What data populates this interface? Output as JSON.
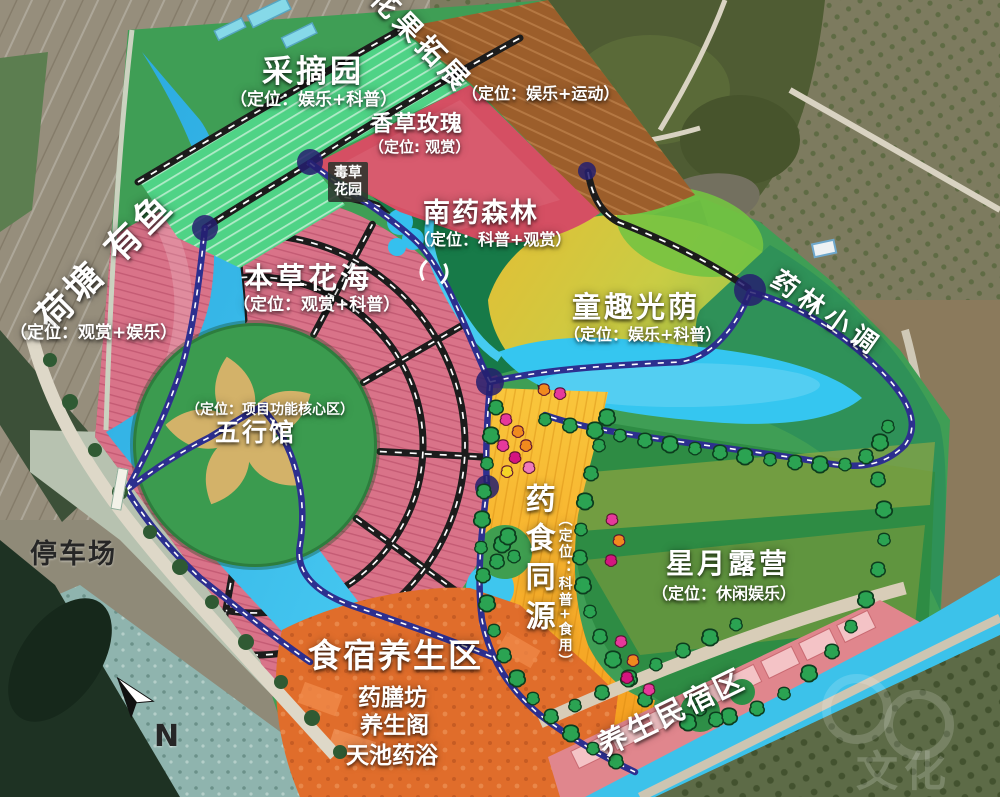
{
  "map": {
    "zones": {
      "caizhaiyuan": {
        "title": "采摘园",
        "subtitle": "（定位：娱乐+科普）"
      },
      "huaguotuozhan": {
        "title": "花果拓展",
        "subtitle": "（定位：娱乐+运动）"
      },
      "xiangcaomeigui": {
        "title": "香草玫瑰",
        "subtitle": "（定位: 观赏）"
      },
      "ducaohuayuan": {
        "line1": "毒草",
        "line2": "花园"
      },
      "nanyaosenlin": {
        "title": "南药森林",
        "subtitle": "（定位：科普+观赏）"
      },
      "hetangyouyu": {
        "title": "荷塘 有鱼",
        "subtitle": "（定位：观赏+娱乐）"
      },
      "bencaohuahai": {
        "title": "本草花海",
        "subtitle": "（定位：观赏+科普）"
      },
      "wuxingguan": {
        "title": "五行馆",
        "subtitle": "（定位：项目功能核心区）"
      },
      "tongquguangyin": {
        "title": "童趣光荫",
        "subtitle": "（定位：娱乐+科普）"
      },
      "yaolinxiaodiao": {
        "title": "药林小调"
      },
      "yaoshitongyuan": {
        "title": "药食同源",
        "subtitle": "（定位：科普+食用）"
      },
      "xingyueluying": {
        "title": "星月露营",
        "subtitle": "（定位：休闲娱乐）"
      },
      "shisuyangsheng": {
        "title": "食宿养生区",
        "items": [
          "药膳坊",
          "养生阁",
          "天池药浴"
        ]
      },
      "yangshengminsu": {
        "title": "养生民宿区"
      },
      "tingchechang": {
        "title": "停车场"
      }
    },
    "compass": {
      "label": "N"
    },
    "watermark": {
      "text": "文化"
    },
    "colors": {
      "water": "#35c6f0",
      "herb_sea": "#d97389",
      "greenhouse": "#4fd386",
      "forest_zone": "#177a48",
      "kids_zone": "#d8c23c",
      "food_band": "#f6ab25",
      "camp_green": "#2e8c44",
      "stay_orange": "#e06d2b",
      "homestay_pink": "#e5868e",
      "road_navy": "#2d2f8f",
      "road_black": "#1c1c1c",
      "star_tan": "#d3b269"
    }
  }
}
